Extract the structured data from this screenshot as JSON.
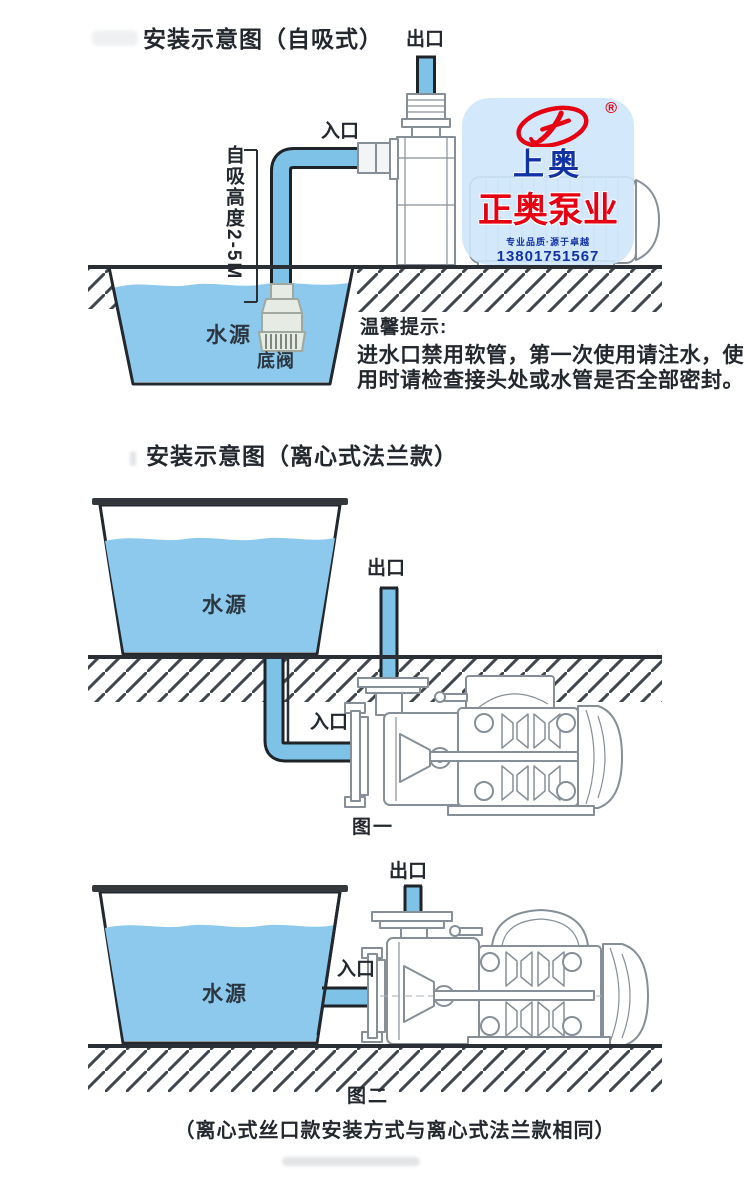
{
  "colors": {
    "water": "#8CC9EC",
    "pipe": "#7EC2E8",
    "outline": "#23282E",
    "hatch": "#3F464D",
    "pump_linework": "#868F98",
    "logo_red": "#E60012",
    "logo_blue": "#1132A5",
    "logo_background": "#CFE7FB"
  },
  "section1": {
    "title": "安装示意图（自吸式）",
    "outlet_label": "出口",
    "inlet_label": "入口",
    "suction_height_label": "自吸高度2-5M",
    "water_source_label": "水源",
    "foot_valve_label": "底阀",
    "tips": {
      "title": "温馨提示:",
      "line1": "进水口禁用软管，第一次使用请注水，使",
      "line2": "用时请检查接头处或水管是否全部密封。"
    }
  },
  "logo": {
    "registered": "®",
    "brand_top": "上奥",
    "brand_main": "正奥泵业",
    "slogan": "专业品质·源于卓越",
    "phone": "13801751567"
  },
  "section2": {
    "title": "安装示意图（离心式法兰款）",
    "outlet_label": "出口",
    "inlet_label": "入口",
    "water_source_label": "水源",
    "figure_caption": "图一"
  },
  "section3": {
    "outlet_label": "出口",
    "inlet_label": "入口",
    "water_source_label": "水源",
    "figure_caption": "图二",
    "note": "（离心式丝口款安装方式与离心式法兰款相同）"
  }
}
